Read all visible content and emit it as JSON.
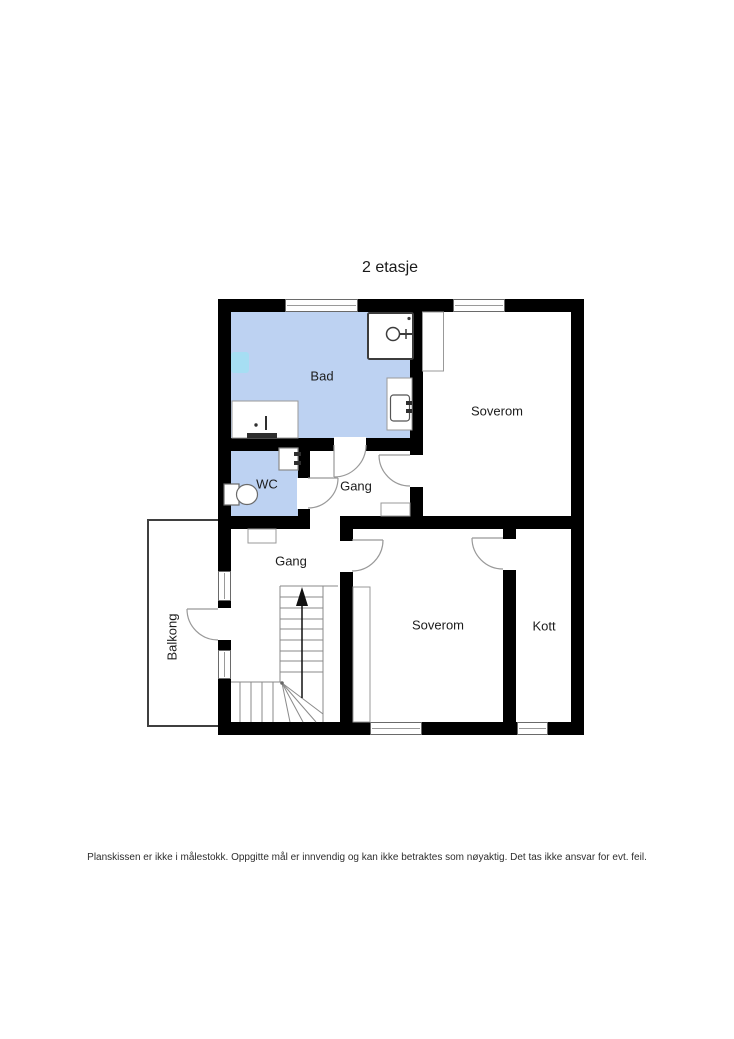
{
  "title": "2 etasje",
  "disclaimer": "Planskissen er ikke i målestokk. Oppgitte mål er innvendig og kan ikke betraktes som nøyaktig. Det tas ikke ansvar for evt. feil.",
  "rooms": {
    "bad": {
      "label": "Bad"
    },
    "wc": {
      "label": "WC"
    },
    "gang_upper": {
      "label": "Gang"
    },
    "gang_lower": {
      "label": "Gang"
    },
    "soverom_top": {
      "label": "Soverom"
    },
    "soverom_bottom": {
      "label": "Soverom"
    },
    "kott": {
      "label": "Kott"
    },
    "balkong": {
      "label": "Balkong"
    }
  },
  "colors": {
    "wet_room_fill": "#bdd2f2",
    "shower_zone_fill": "#a6def3",
    "wall": "#000000",
    "fixture_line": "#999999"
  }
}
